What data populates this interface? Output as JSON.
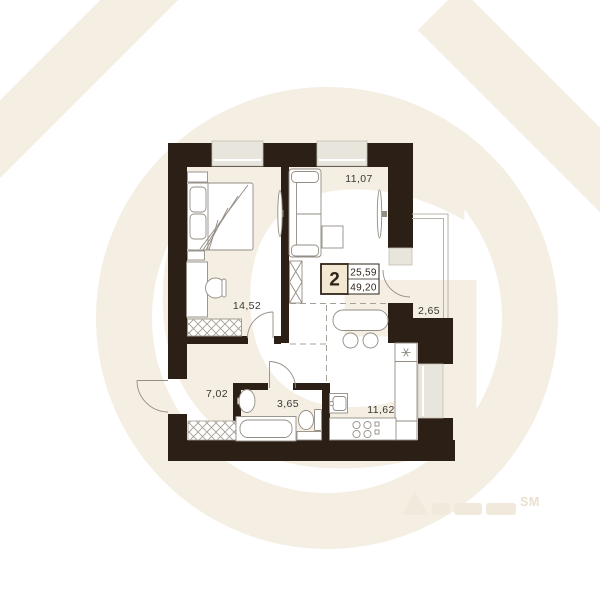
{
  "watermark": {
    "letter": "G",
    "tm": "SM",
    "color": "#f4eee3"
  },
  "plan": {
    "type": "apartment-floorplan",
    "badge": {
      "rooms": "2",
      "upper": "25,59",
      "lower": "49,20"
    },
    "labels": {
      "bedroom": "14,52",
      "living": "11,07",
      "loggia": "2,65",
      "hall": "7,02",
      "bath": "3,65",
      "kitchen": "11,62"
    },
    "colors": {
      "wall": "#2c2016",
      "window_fill": "#e8e5dd",
      "window_stroke": "#c5bfb4",
      "furniture_line": "#938d84",
      "dash_line": "#a8a197",
      "label_text": "#3a3833",
      "badge_fill": "#f3e8d2",
      "badge_border": "#30241a"
    }
  }
}
